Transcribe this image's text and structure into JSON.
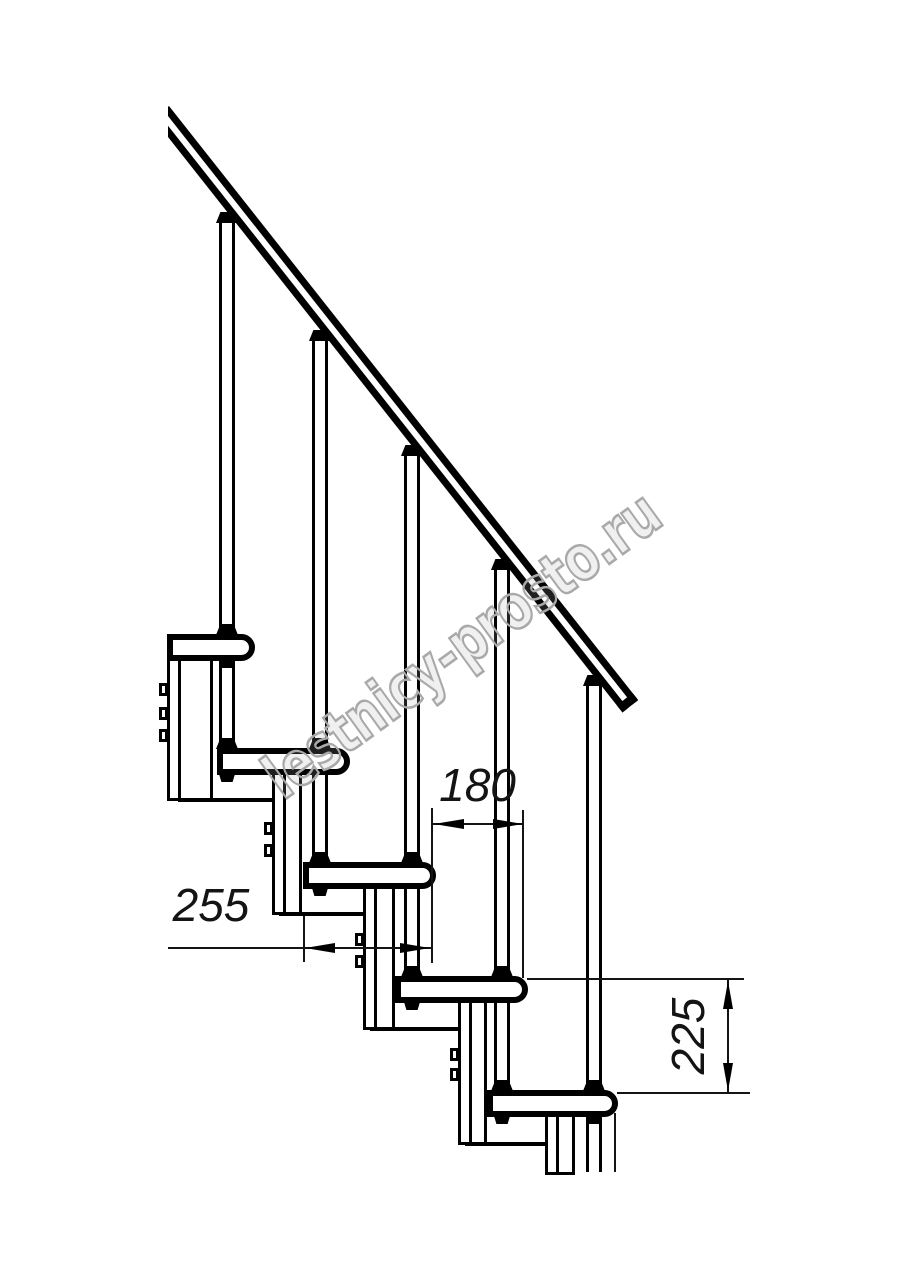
{
  "watermark": {
    "text": "lestnicy-prosto.ru",
    "color": "#a9a9a9"
  },
  "dimensions": {
    "going": "180",
    "tread_depth": "255",
    "rise": "225"
  },
  "colors": {
    "line": "#000000",
    "background": "#ffffff",
    "dimension": "#141414"
  }
}
